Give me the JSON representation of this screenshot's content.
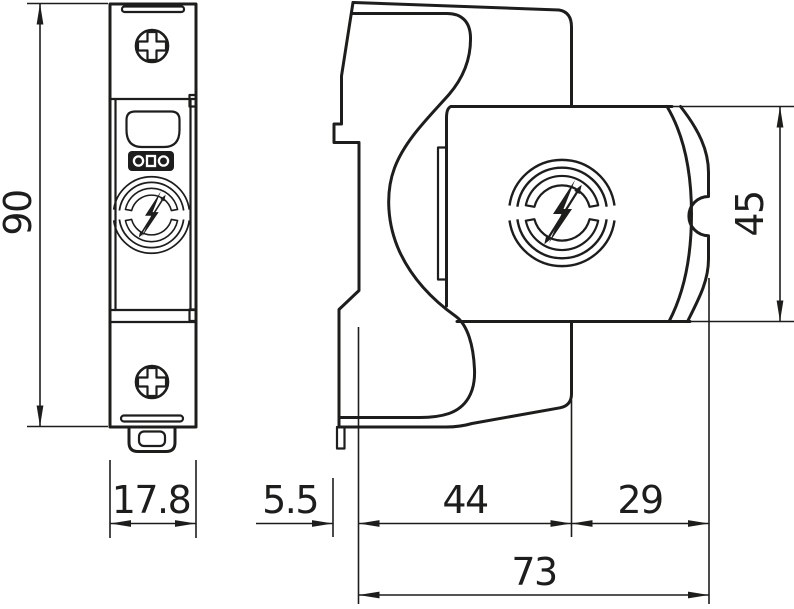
{
  "drawing": {
    "background": "#ffffff",
    "line_color": "#1d1d1b",
    "description_domain": "device dimension drawing, front view and side view",
    "dimensions": {
      "front_height": "90",
      "front_width": "17.8",
      "rail_depth": "5.5",
      "base_depth": "44",
      "module_depth": "29",
      "total_depth": "73",
      "module_height": "45"
    },
    "icons": {
      "screw": "phillips-screw-icon",
      "surge_logo": "surge-arrester-lightning-logo-icon",
      "brand_logo": "obo-brand-logo-icon"
    }
  }
}
